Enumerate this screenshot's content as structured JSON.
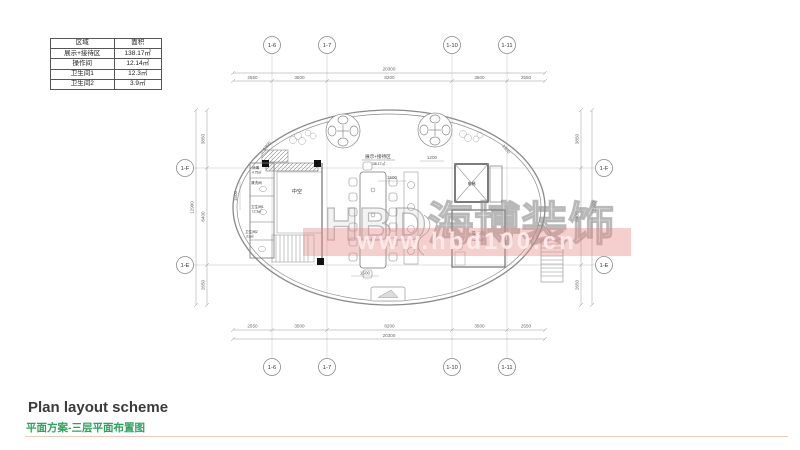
{
  "area_table": {
    "headers": [
      "区域",
      "面积"
    ],
    "rows": [
      [
        "展示+接待区",
        "138.17㎡"
      ],
      [
        "操作间",
        "12.14㎡"
      ],
      [
        "卫生间1",
        "12.3㎡"
      ],
      [
        "卫生间2",
        "3.9㎡"
      ]
    ]
  },
  "grid_bubbles": {
    "top": [
      "1-6",
      "1-7",
      "1-10",
      "1-11"
    ],
    "bottom": [
      "1-6",
      "1-7",
      "1-10",
      "1-11"
    ],
    "left": [
      "1-F",
      "1-E"
    ],
    "right": [
      "1-F",
      "1-E"
    ]
  },
  "dims": {
    "h_total": "20300",
    "h_segments": [
      "2550",
      "3500",
      "8200",
      "3500",
      "2550"
    ],
    "v_total": "12900",
    "v_segments": [
      "3850",
      "6400",
      "2650"
    ],
    "interior": {
      "d1": "1500",
      "d2": "1500",
      "d3": "1200",
      "d4": "1500",
      "d5": "1300",
      "d6": "1300"
    }
  },
  "rooms": {
    "exhibition": {
      "name": "展示+接待区",
      "area": "138.17㎡"
    },
    "operation": {
      "name": "操作间",
      "area": "12.14㎡"
    },
    "void_label": "中空",
    "elevator": "电梯",
    "disinfect": {
      "name": "消毒",
      "area": "4.75㎡"
    },
    "cleaning": {
      "name": "清洗间"
    },
    "toilet1": {
      "name": "卫生间1",
      "area": "12.3㎡"
    },
    "toilet2": {
      "name": "卫生间2",
      "area": "3.9㎡"
    }
  },
  "watermark": {
    "brand": "HBD海博装饰",
    "url": "www.hbd100.cn"
  },
  "footer": {
    "title_en": "Plan layout scheme",
    "title_cn": "平面方案-三层平面布置图"
  },
  "colors": {
    "accent_green": "#2ea35c",
    "underline": "#e8cbbc",
    "watermark_pink": "#e88a8a",
    "line_gray": "#8a8a8a"
  }
}
